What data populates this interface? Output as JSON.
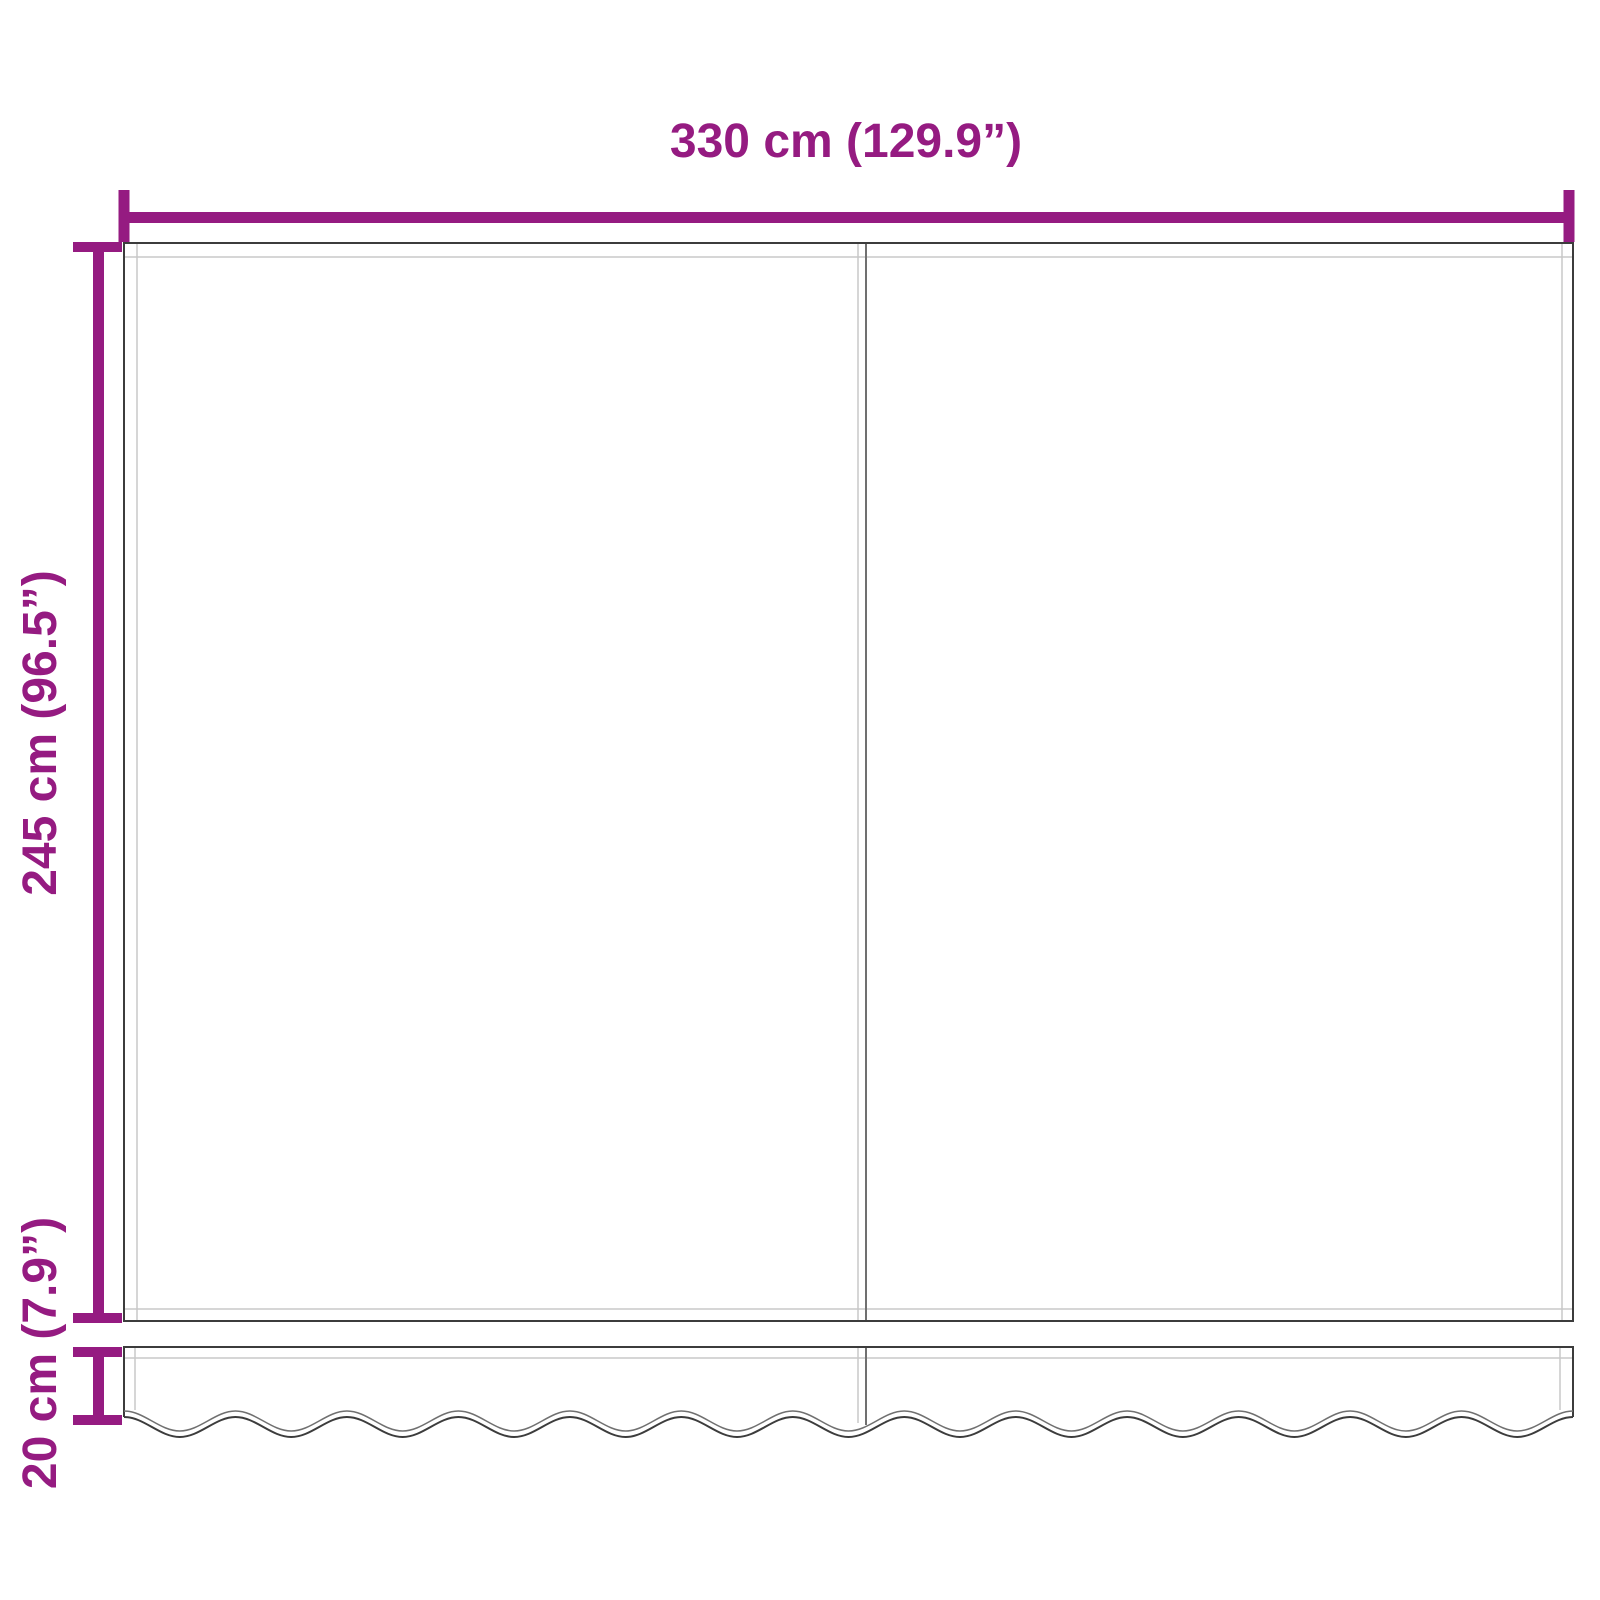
{
  "labels": {
    "width": "330 cm (129.9”)",
    "height": "245 cm (96.5”)",
    "valance": "20 cm (7.9”)"
  },
  "colors": {
    "dimension_accent": "#951B81",
    "fabric_outline": "#3C3C3C",
    "stitch_line": "#C8C8C8",
    "seam_line": "#707070",
    "background": "#FFFFFF"
  }
}
